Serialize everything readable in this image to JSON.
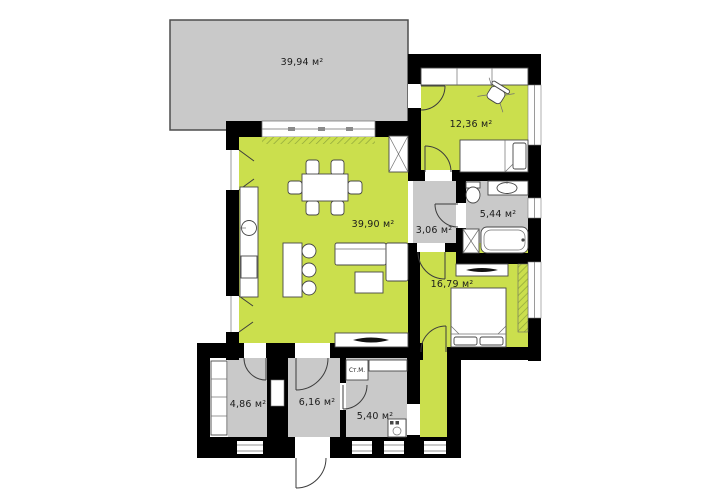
{
  "plan_title": "floor-plan",
  "colors": {
    "living_zone_green": "#cbdf4d",
    "service_zone_gray": "#c9c9c9",
    "terrace_gray": "#c9c9c9",
    "wall_black": "#000000",
    "hatch_green": "#8ea53a"
  },
  "rooms": [
    {
      "id": "terrace",
      "area_label": "39,94 м²"
    },
    {
      "id": "bedroom-top",
      "area_label": "12,36 м²"
    },
    {
      "id": "living-room",
      "area_label": "39,90 м²"
    },
    {
      "id": "hall",
      "area_label": "3,06 м²"
    },
    {
      "id": "bathroom",
      "area_label": "5,44 м²"
    },
    {
      "id": "bedroom-main",
      "area_label": "16,79 м²"
    },
    {
      "id": "storage",
      "area_label": "4,86 м²"
    },
    {
      "id": "entry-hall",
      "area_label": "6,16 м²"
    },
    {
      "id": "utility",
      "area_label": "5,40 м²"
    }
  ],
  "fixtures": {
    "washer_label": "Ст.М."
  }
}
